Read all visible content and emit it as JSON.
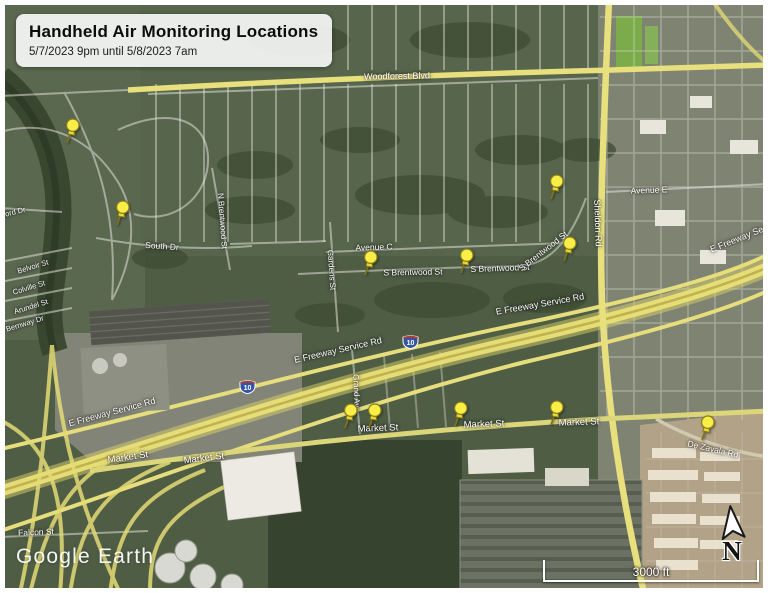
{
  "map": {
    "title_box": {
      "title": "Handheld Air Monitoring Locations",
      "subtitle": "5/7/2023 9pm until 5/8/2023 7am"
    },
    "watermark": "Google Earth",
    "scale_bar": {
      "label": "3000 ft"
    },
    "compass": {
      "label": "N"
    },
    "colors": {
      "pin_head": "#f8ee46",
      "pin_outline": "#8a7d1f",
      "road_yellow": "#e8e07c",
      "shield_blue": "#3355a4",
      "shield_red": "#b23b34",
      "label_text": "#ffffff"
    },
    "monitoring_pins": [
      {
        "id": "pin-01",
        "x": 67,
        "y": 143
      },
      {
        "id": "pin-02",
        "x": 117,
        "y": 225
      },
      {
        "id": "pin-03",
        "x": 365,
        "y": 275
      },
      {
        "id": "pin-04",
        "x": 461,
        "y": 273
      },
      {
        "id": "pin-05",
        "x": 551,
        "y": 199
      },
      {
        "id": "pin-06",
        "x": 564,
        "y": 261
      },
      {
        "id": "pin-07",
        "x": 345,
        "y": 428
      },
      {
        "id": "pin-08",
        "x": 369,
        "y": 428
      },
      {
        "id": "pin-09",
        "x": 455,
        "y": 426
      },
      {
        "id": "pin-10",
        "x": 551,
        "y": 425
      },
      {
        "id": "pin-11",
        "x": 702,
        "y": 440
      }
    ],
    "highway_shields": [
      {
        "label": "10",
        "x": 410,
        "y": 341
      },
      {
        "label": "10",
        "x": 247,
        "y": 386
      }
    ],
    "street_labels": [
      {
        "text": "Woodforest Blvd",
        "x": 397,
        "y": 76,
        "rot": -1,
        "size": 9
      },
      {
        "text": "South Dr",
        "x": 162,
        "y": 246,
        "rot": 4,
        "size": 8.5
      },
      {
        "text": "N Brentwood St",
        "x": 222,
        "y": 221,
        "rot": 86,
        "size": 8
      },
      {
        "text": "Sheldon Rd",
        "x": 598,
        "y": 223,
        "rot": 88,
        "size": 9
      },
      {
        "text": "Gardens St",
        "x": 331,
        "y": 270,
        "rot": 86,
        "size": 8
      },
      {
        "text": "Avenue C",
        "x": 374,
        "y": 247,
        "rot": -2,
        "size": 8.5
      },
      {
        "text": "S Brentwood St",
        "x": 413,
        "y": 272,
        "rot": -1,
        "size": 8.5
      },
      {
        "text": "S Brentwood St",
        "x": 500,
        "y": 268,
        "rot": -2,
        "size": 8.5
      },
      {
        "text": "S Brentwood St",
        "x": 543,
        "y": 251,
        "rot": -38,
        "size": 8.5
      },
      {
        "text": "Avenue E",
        "x": 649,
        "y": 190,
        "rot": -2,
        "size": 8.5
      },
      {
        "text": "E Freeway Service Rd",
        "x": 338,
        "y": 350,
        "rot": -13,
        "size": 9
      },
      {
        "text": "E Freeway Service Rd",
        "x": 540,
        "y": 304,
        "rot": -10,
        "size": 9
      },
      {
        "text": "E Freeway Service Rd",
        "x": 112,
        "y": 412,
        "rot": -15,
        "size": 9
      },
      {
        "text": "E Freeway Service Rd",
        "x": 752,
        "y": 233,
        "rot": -22,
        "size": 9
      },
      {
        "text": "Market St",
        "x": 128,
        "y": 458,
        "rot": -8,
        "size": 9.5
      },
      {
        "text": "Market St",
        "x": 204,
        "y": 459,
        "rot": -7,
        "size": 9.5
      },
      {
        "text": "Market St",
        "x": 378,
        "y": 429,
        "rot": -2,
        "size": 9.5
      },
      {
        "text": "Market St",
        "x": 484,
        "y": 425,
        "rot": -2,
        "size": 9.5
      },
      {
        "text": "Market St",
        "x": 579,
        "y": 423,
        "rot": -2,
        "size": 9.5
      },
      {
        "text": "Grand Ave",
        "x": 356,
        "y": 393,
        "rot": 88,
        "size": 8
      },
      {
        "text": "De Zavala Rd",
        "x": 713,
        "y": 449,
        "rot": 13,
        "size": 8.5
      },
      {
        "text": "Falcon St",
        "x": 36,
        "y": 532,
        "rot": -2,
        "size": 8.5
      },
      {
        "text": "Belvoir St",
        "x": 33,
        "y": 267,
        "rot": -17,
        "size": 7.5
      },
      {
        "text": "Colville St",
        "x": 29,
        "y": 288,
        "rot": -17,
        "size": 7.5
      },
      {
        "text": "Arundel St",
        "x": 31,
        "y": 307,
        "rot": -17,
        "size": 7.5
      },
      {
        "text": "Bernway Dr",
        "x": 25,
        "y": 324,
        "rot": -17,
        "size": 7.5
      },
      {
        "text": "Wofford Dr",
        "x": 8,
        "y": 214,
        "rot": -14,
        "size": 7.5
      }
    ]
  }
}
